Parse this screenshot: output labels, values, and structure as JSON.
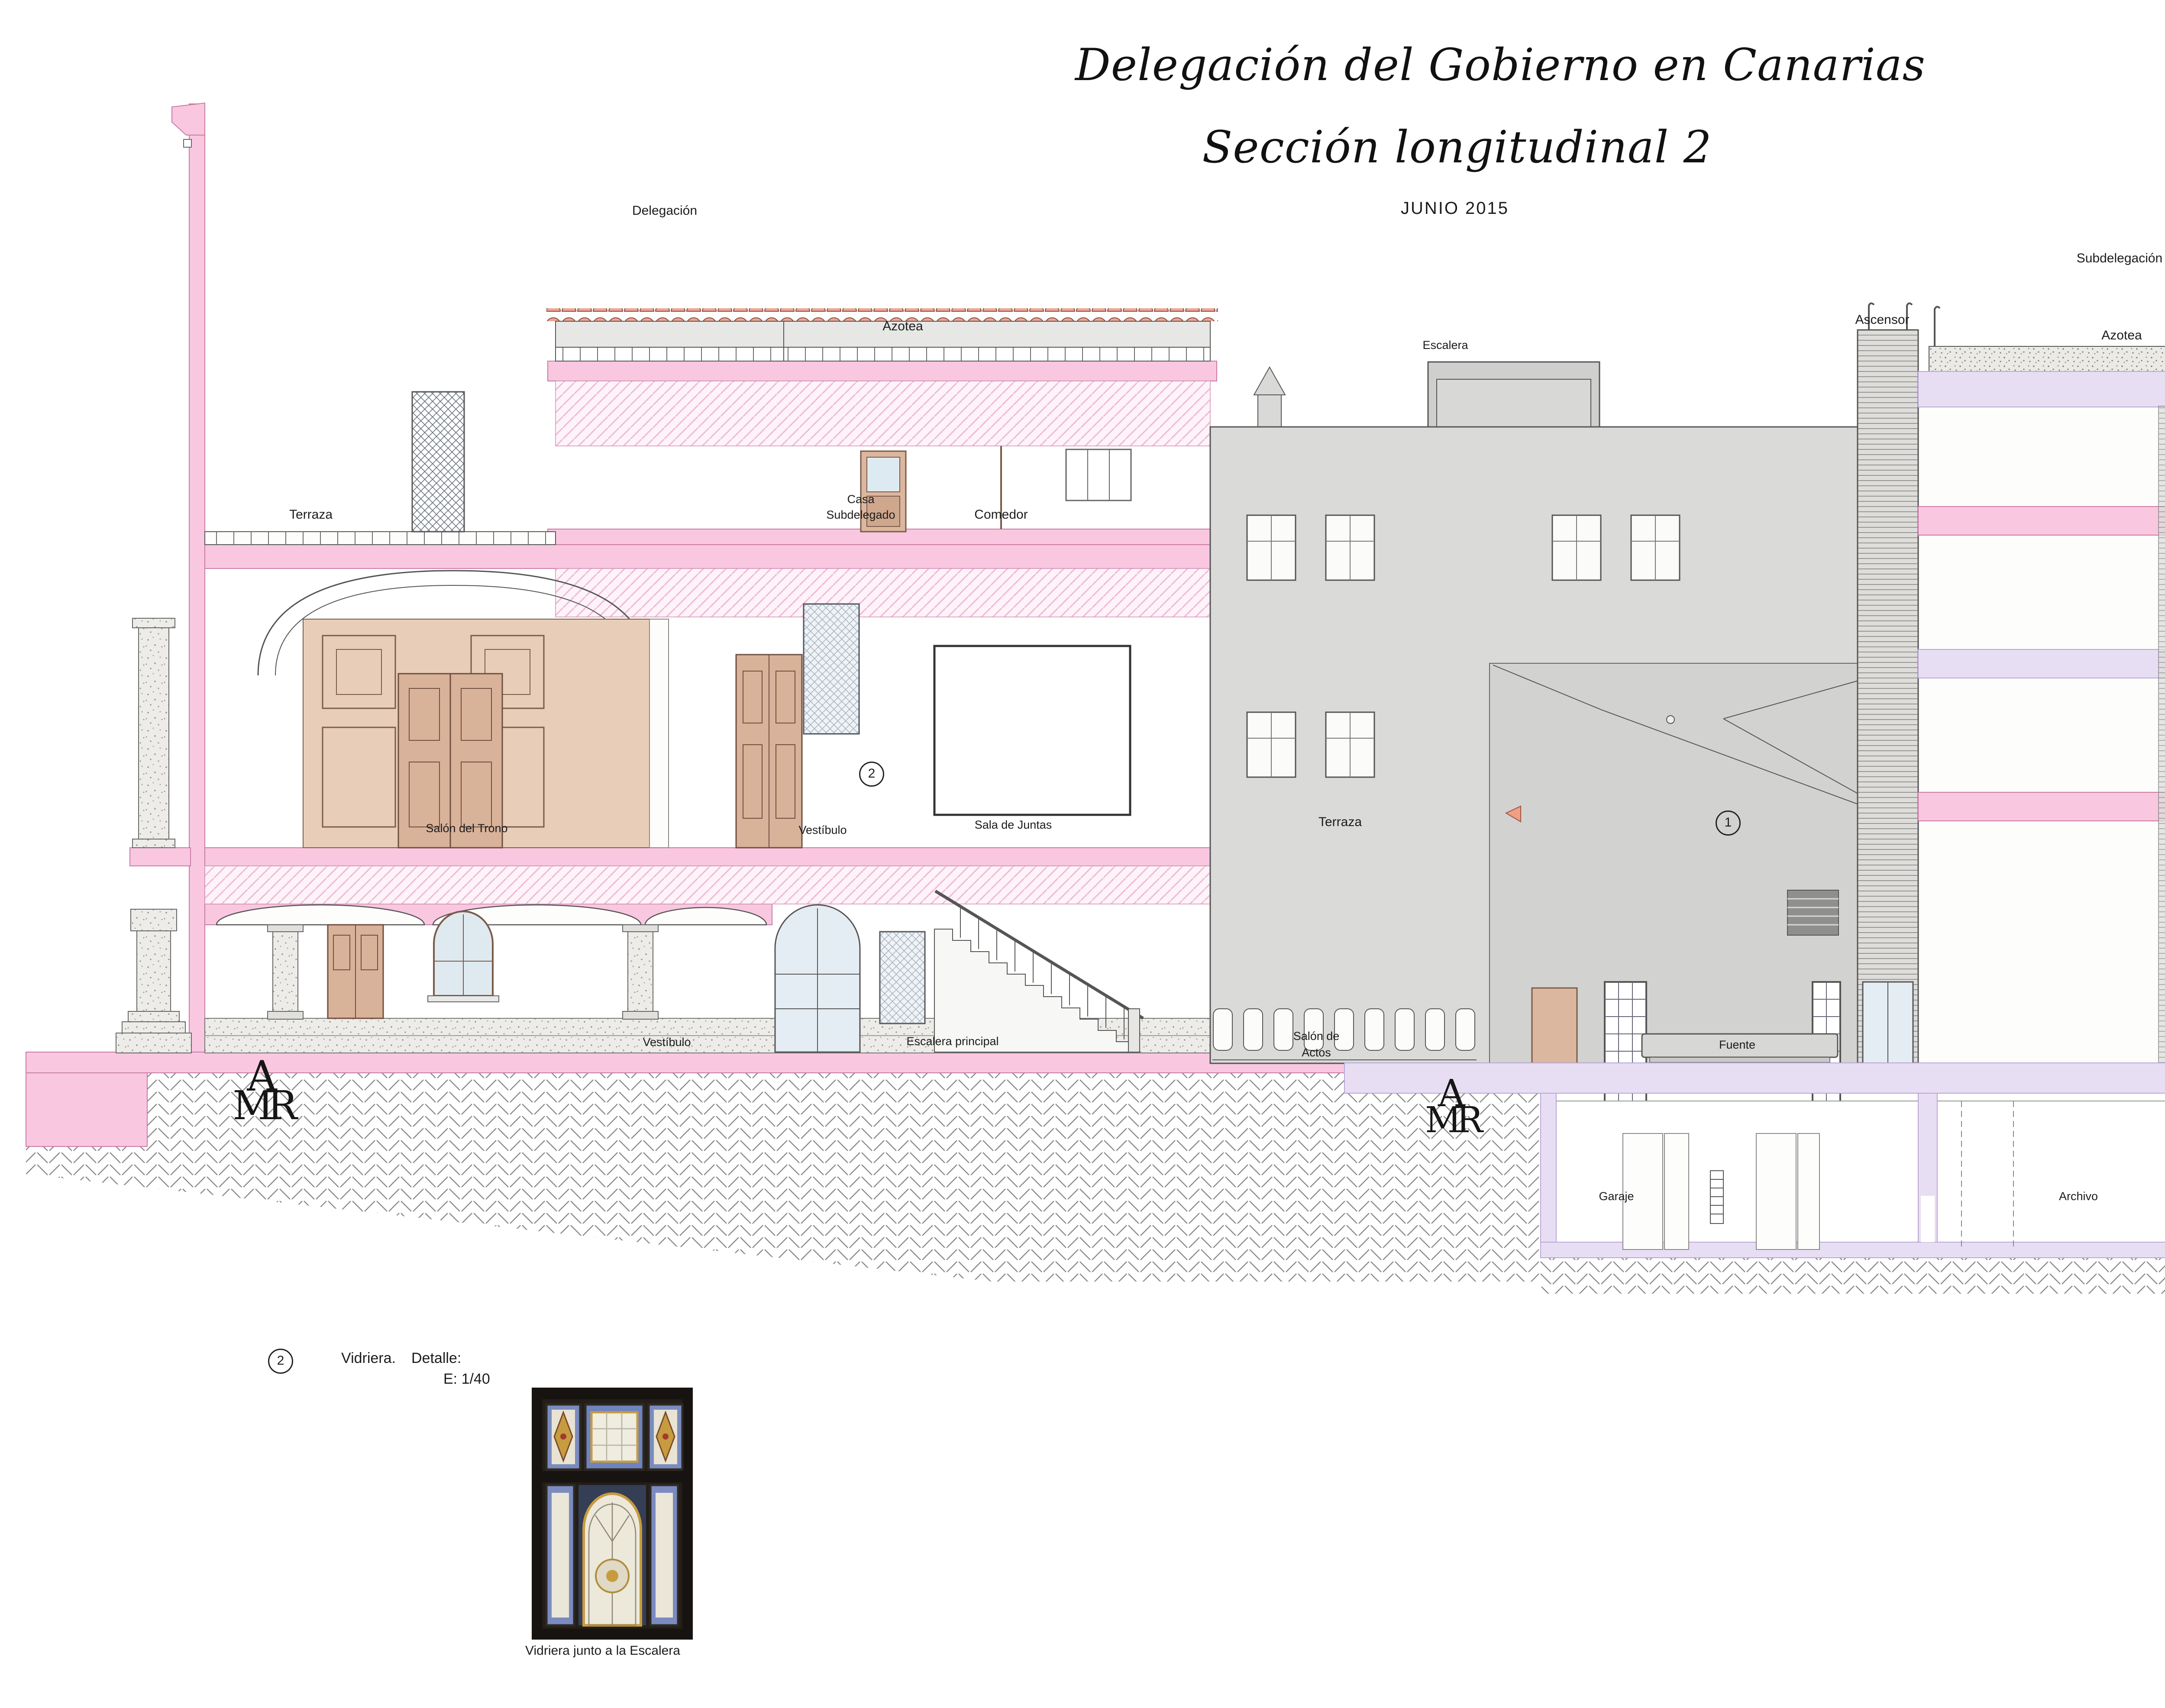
{
  "document": {
    "title": "Delegación del Gobierno en Canarias",
    "subtitle": "Sección longitudinal 2",
    "date": "JUNIO  2015"
  },
  "legend": {
    "fase1_label": "Fase 1. Arquitecto Eduardo Laforet. Año 1.948.",
    "fase2_label_line1": "Fase 2. Reforma Arquitectos Emilio García-Conde",
    "fase2_label_line2": "Julio C. Alonso Alvarez. Año 1.998.",
    "fase1_color": "#f9c7e0",
    "fase2_color": "#e8def4"
  },
  "notes": {
    "note1_number": "1",
    "note1_text": "Toldo de sombra.",
    "note2_number": "2",
    "note2_title": "Vidriera.",
    "note2_detail_label": "Detalle:",
    "note2_scale": "E: 1/40",
    "vidriera_caption": "Vidriera junto a la Escalera"
  },
  "section_labels": {
    "delegacion": "Delegación",
    "subdelegacion": "Subdelegación",
    "azotea_left": "Azotea",
    "azotea_right": "Azotea",
    "terraza_left": "Terraza",
    "terraza_center": "Terraza",
    "terraza_right": "Terraza",
    "casa_subdelegado_line1": "Casa",
    "casa_subdelegado_line2": "Subdelegado",
    "comedor": "Comedor",
    "salon_del_trono": "Salón del Trono",
    "vestibulo_principal": "Vestíbulo",
    "sala_de_juntas": "Sala de Juntas",
    "escalera": "Escalera",
    "ascensor": "Ascensor",
    "salon_de_actos_line1": "Salón de",
    "salon_de_actos_line2": "Actos",
    "vestibulo_ground": "Vestíbulo",
    "escalera_principal": "Escalera  principal",
    "fuente": "Fuente",
    "garaje": "Garaje",
    "archivo_1": "Archivo",
    "archivo_2": "Archivo",
    "marker_toldo": "1",
    "marker_vidriera": "2"
  },
  "monogram": {
    "top": "A",
    "bottom": "MR"
  },
  "scale_bar": {
    "title": "ESCALA  GRÁFICA",
    "tick_0": "0m",
    "tick_5": "5m",
    "tick_10": "10m"
  },
  "logo": {
    "monogram_top": "A",
    "monogram_bottom": "MR",
    "line1": "LEVANTAMIENTOS",
    "line2": "ARQUITECTÓNICOS",
    "line3": "Y ARQUEOLÓGICOS",
    "url": "www.levantamientos.com"
  },
  "colors": {
    "fase1_pink": "#f9c7e0",
    "fase2_lavender": "#e8def4",
    "facade_gray": "#dadad8",
    "patio_gray": "#d2d2d0",
    "wood_tan": "#d9b29a",
    "roof_tile_salmon": "#eca794",
    "brick_red": "#d4593c",
    "ink": "#1c1c1c"
  }
}
